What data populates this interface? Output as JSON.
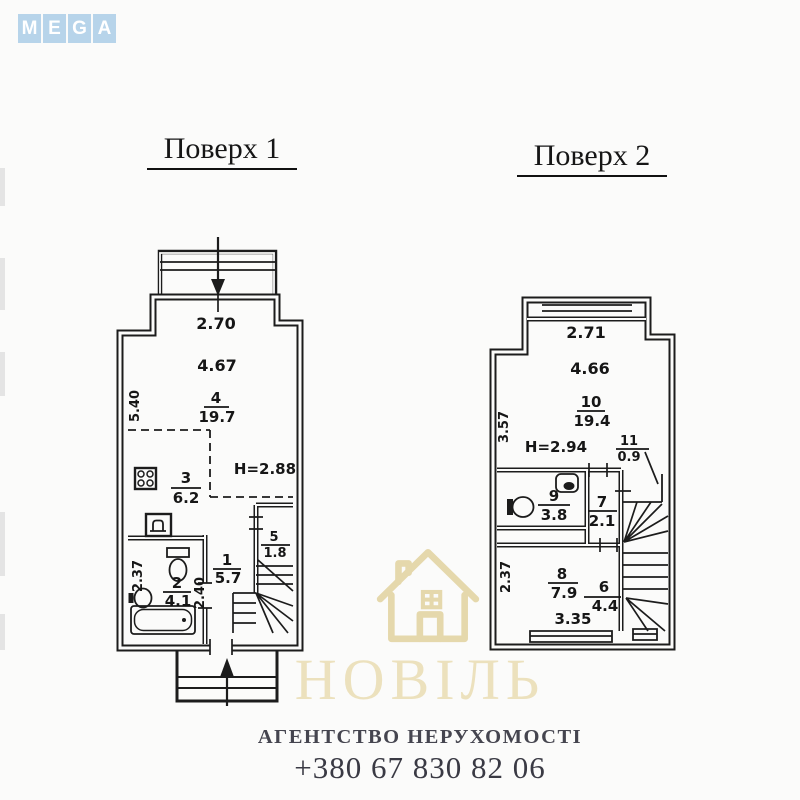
{
  "logo": {
    "letters": [
      "M",
      "E",
      "G",
      "A"
    ],
    "tile_color": "#b7d4ea"
  },
  "f1": {
    "title": "Поверх 1",
    "dims": {
      "top": "2.70",
      "width": "4.67",
      "left": "5.40",
      "ceiling": "Н=2.88",
      "bath": "2.37",
      "hall": "2.40"
    },
    "rooms": [
      {
        "num": "4",
        "area": "19.7"
      },
      {
        "num": "3",
        "area": "6.2"
      },
      {
        "num": "5",
        "area": "1.8"
      },
      {
        "num": "1",
        "area": "5.7"
      },
      {
        "num": "2",
        "area": "4.1"
      }
    ]
  },
  "f2": {
    "title": "Поверх 2",
    "dims": {
      "top": "2.71",
      "width": "4.66",
      "left": "3.57",
      "ceiling": "Н=2.94",
      "bed_height": "2.37",
      "bed_width": "3.35"
    },
    "rooms": [
      {
        "num": "10",
        "area": "19.4"
      },
      {
        "num": "11",
        "area": "0.9"
      },
      {
        "num": "9",
        "area": "3.8"
      },
      {
        "num": "7",
        "area": "2.1"
      },
      {
        "num": "8",
        "area": "7.9"
      },
      {
        "num": "6",
        "area": "4.4"
      }
    ]
  },
  "watermark": {
    "icon": "house",
    "brand": "НОВІЛЬ",
    "subtitle": "АГЕНТСТВО НЕРУХОМОСТІ",
    "phone": "+380 67 830 82 06",
    "color": "#ece1bd"
  }
}
